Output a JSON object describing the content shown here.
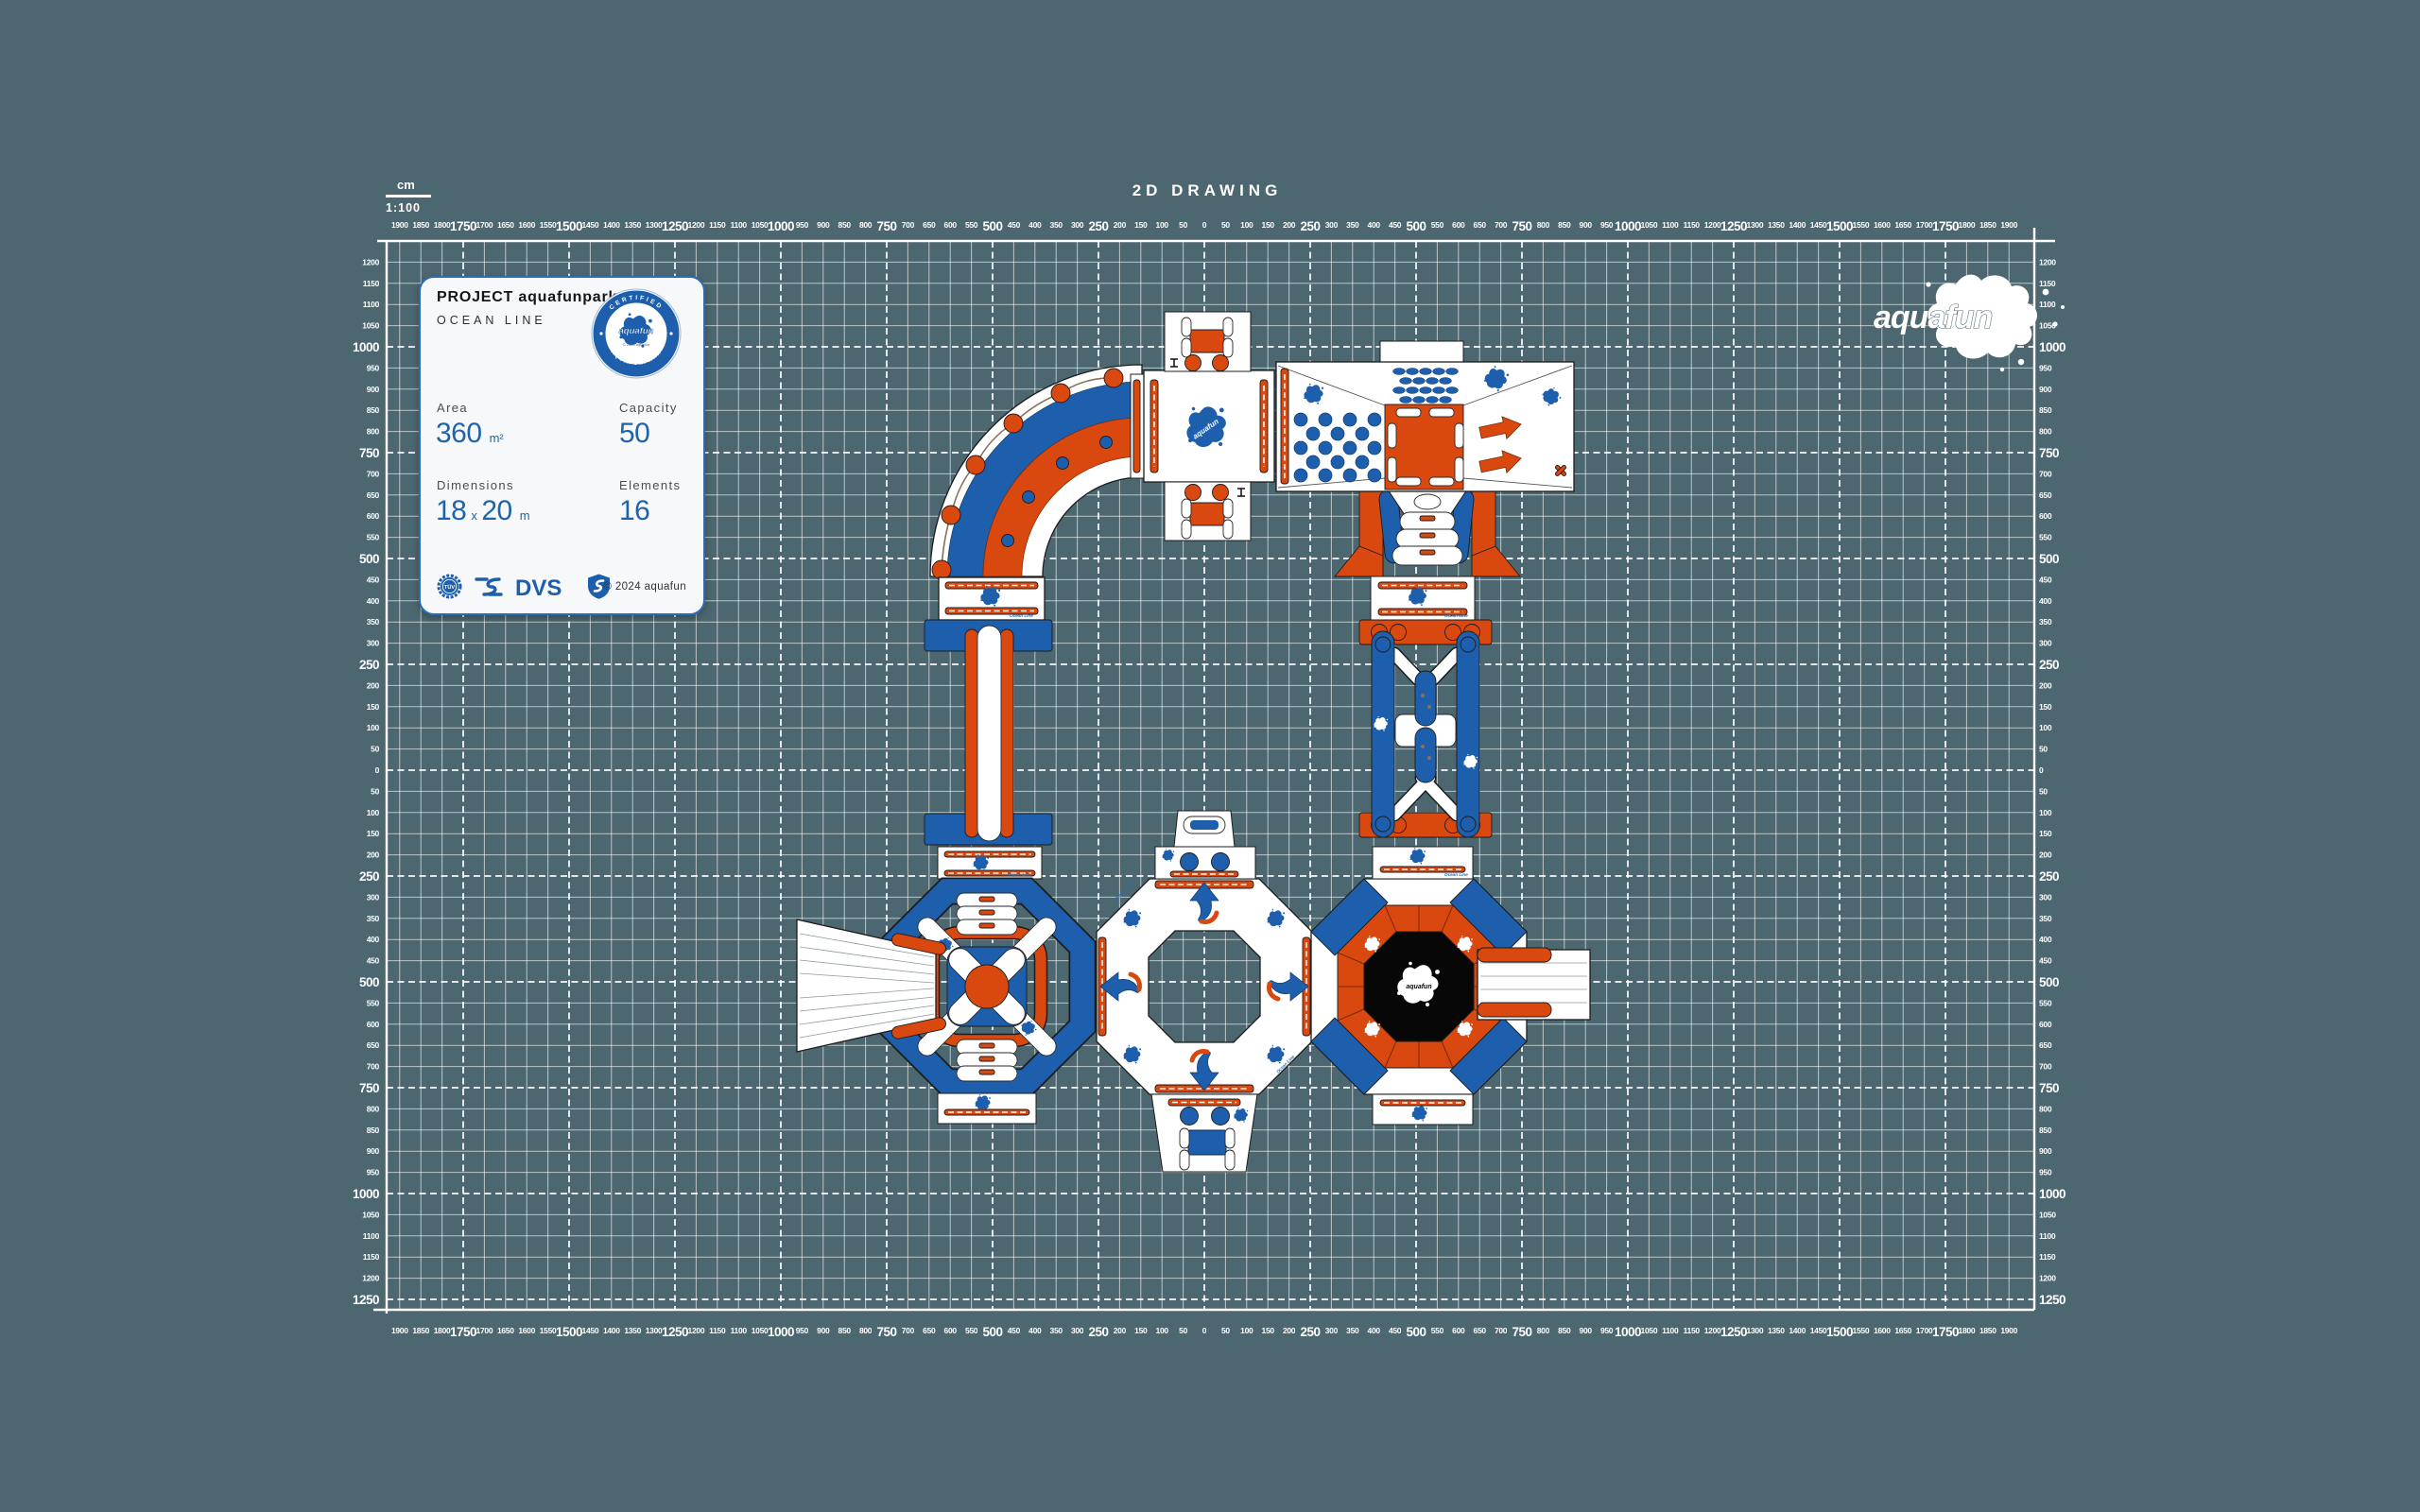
{
  "title": "2D DRAWING",
  "scale": {
    "unit": "cm",
    "ratio": "1:100"
  },
  "brand": {
    "name": "aquafun"
  },
  "info_card": {
    "project": "PROJECT aquafunpark",
    "line": "OCEAN LINE",
    "badge": {
      "arc_top": "CERTIFIED",
      "arc_bottom": "AQUAFUNPARK",
      "brand": "aquafun",
      "small": "© 2024 aquafun"
    },
    "area_label": "Area",
    "area_value": "360",
    "area_unit": "m²",
    "capacity_label": "Capacity",
    "capacity_value": "50",
    "dimensions_label": "Dimensions",
    "dim_a": "18",
    "dim_sep": "x",
    "dim_b": "20",
    "dim_unit": "m",
    "elements_label": "Elements",
    "elements_value": "16",
    "certs": {
      "tuv": "TÜV",
      "dvs": "DVS"
    },
    "copyright": "© 2024 aquafun"
  },
  "park": {
    "line_label": "Ocean Line",
    "brand_label": "aquafun"
  },
  "rulers": {
    "h_min": -1900,
    "h_max": 1900,
    "v_min": -1200,
    "v_max": 1250,
    "step": 50,
    "major_every": 250
  },
  "colors": {
    "background": "#4d6770",
    "grid": "#ffffff",
    "orange": "#d9480f",
    "blue": "#1d5fad",
    "navy": "#10335f",
    "black": "#0a0a0a",
    "card_bg": "#f7f8fa",
    "card_border": "#2e6cb5",
    "value_blue": "#1d64ad"
  }
}
